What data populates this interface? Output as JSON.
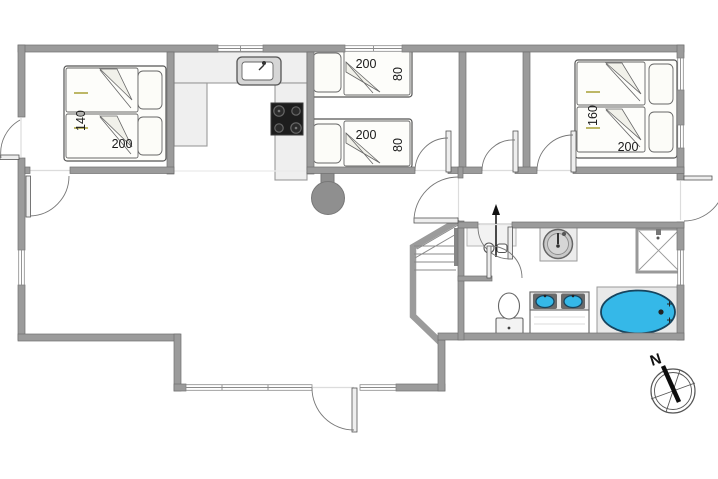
{
  "plan": {
    "type": "house-floor-plan",
    "compass_label": "N",
    "dimensions": {
      "bedroom_left_bed": {
        "width_cm": "140",
        "length_cm": "200"
      },
      "alcove_bed_top": {
        "length_cm": "200",
        "width_cm": "80"
      },
      "alcove_bed_bottom": {
        "length_cm": "200",
        "width_cm": "80"
      },
      "bedroom_right_bed": {
        "width_cm": "160",
        "length_cm": "200"
      }
    },
    "fixtures": [
      "kitchen-sink",
      "cooktop",
      "wood-stove",
      "staircase",
      "entrance-arrow",
      "round-washbasin",
      "shower",
      "toilet",
      "double-washbasin",
      "bathtub",
      "compass-rose"
    ],
    "colors": {
      "wall": "#9b9b9b",
      "wall_edge": "#6f6f6f",
      "counter": "#efefef",
      "cooktop": "#1d1d1d",
      "appliance_gray": "#8f8f8f",
      "water_blue": "#35b8e8",
      "dimension_tick_olive": "#a8a035",
      "label_text": "#1a1a1a"
    }
  }
}
